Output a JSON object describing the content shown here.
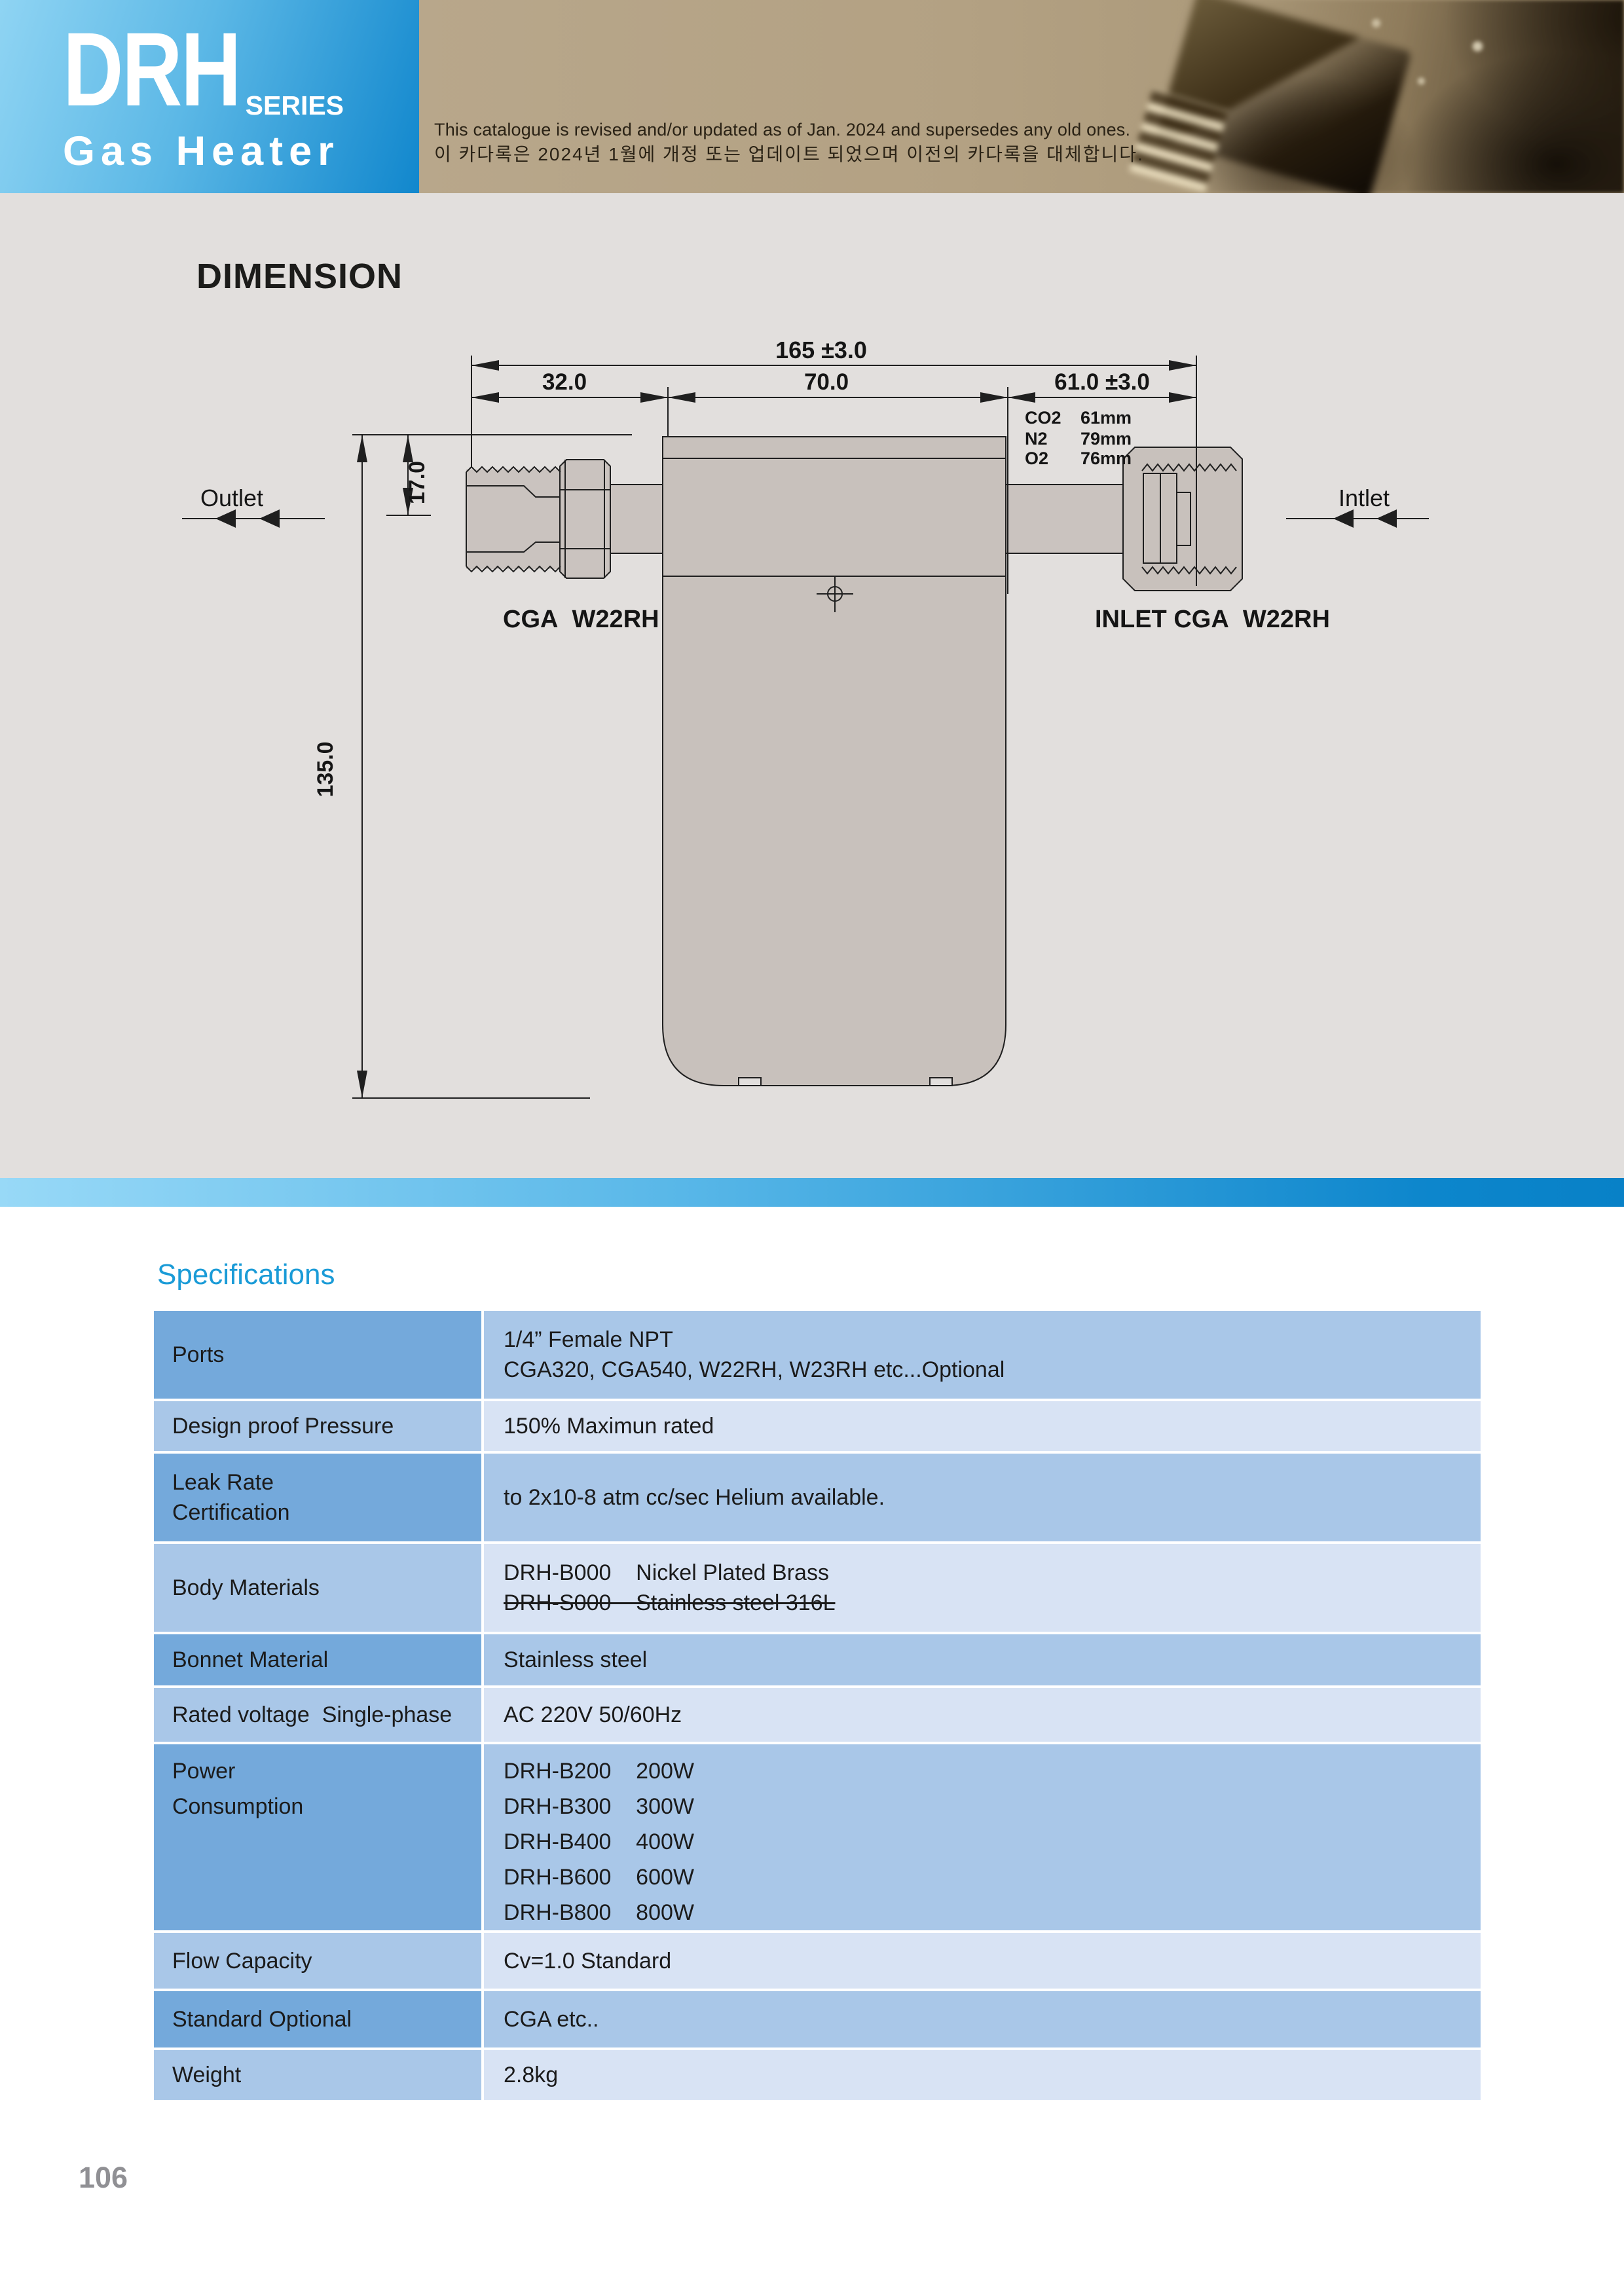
{
  "header": {
    "series": "DRH",
    "series_suffix": "SERIES",
    "product": "Gas Heater",
    "revision_en": "This catalogue is revised and/or updated as of Jan. 2024 and supersedes any old ones.",
    "revision_ko": "이 카다록은 2024년 1월에 개정 또는 업데이트 되었으며 이전의 카다록을 대체합니다."
  },
  "dimension": {
    "title": "DIMENSION",
    "overall_width": "165 ±3.0",
    "seg_left": "32.0",
    "seg_mid": "70.0",
    "seg_right": "61.0 ±3.0",
    "port_offset": "17.0",
    "body_height": "135.0",
    "gas_lengths": [
      {
        "gas": "CO2",
        "len": "61mm"
      },
      {
        "gas": "N2",
        "len": "79mm"
      },
      {
        "gas": "O2",
        "len": "76mm"
      }
    ],
    "outlet_label": "Outlet",
    "inlet_label": "Intlet",
    "outlet_port_label": "CGA  W22RH",
    "inlet_port_label": "INLET CGA  W22RH"
  },
  "specs": {
    "title": "Specifications",
    "rows": [
      {
        "label": "Ports",
        "value": "1/4” Female NPT\n CGA320, CGA540, W22RH, W23RH etc...Optional"
      },
      {
        "label": "Design proof Pressure",
        "value": "150% Maximun rated"
      },
      {
        "label": "Leak Rate\nCertification",
        "value": "to 2x10-8 atm cc/sec Helium available."
      },
      {
        "label": "Body Materials",
        "value": "DRH-B000    Nickel Plated Brass",
        "value_struck": "DRH-S000    Stainless steel 316L"
      },
      {
        "label": "Bonnet Material",
        "value": "Stainless steel"
      },
      {
        "label": "Rated voltage  Single-phase",
        "value": "AC 220V 50/60Hz"
      },
      {
        "label": "Power\nConsumption",
        "value": "DRH-B200    200W\nDRH-B300    300W\nDRH-B400    400W\nDRH-B600    600W\nDRH-B800    800W"
      },
      {
        "label": "Flow Capacity",
        "value": "Cv=1.0 Standard"
      },
      {
        "label": "Standard Optional",
        "value": "CGA etc.."
      },
      {
        "label": "Weight",
        "value": "2.8kg"
      }
    ]
  },
  "footer": {
    "page_number": "106"
  },
  "colors": {
    "accent_blue": "#1a9bd7",
    "logo_gradient_start": "#8fd4f3",
    "logo_gradient_end": "#1187cd",
    "banner_tan": "#b3a183",
    "row_dark": "#74a9db",
    "row_medium": "#a9c7e8",
    "row_light": "#d8e3f4",
    "drawing_bg": "#e2dfdd",
    "part_fill": "#cac3bf"
  }
}
